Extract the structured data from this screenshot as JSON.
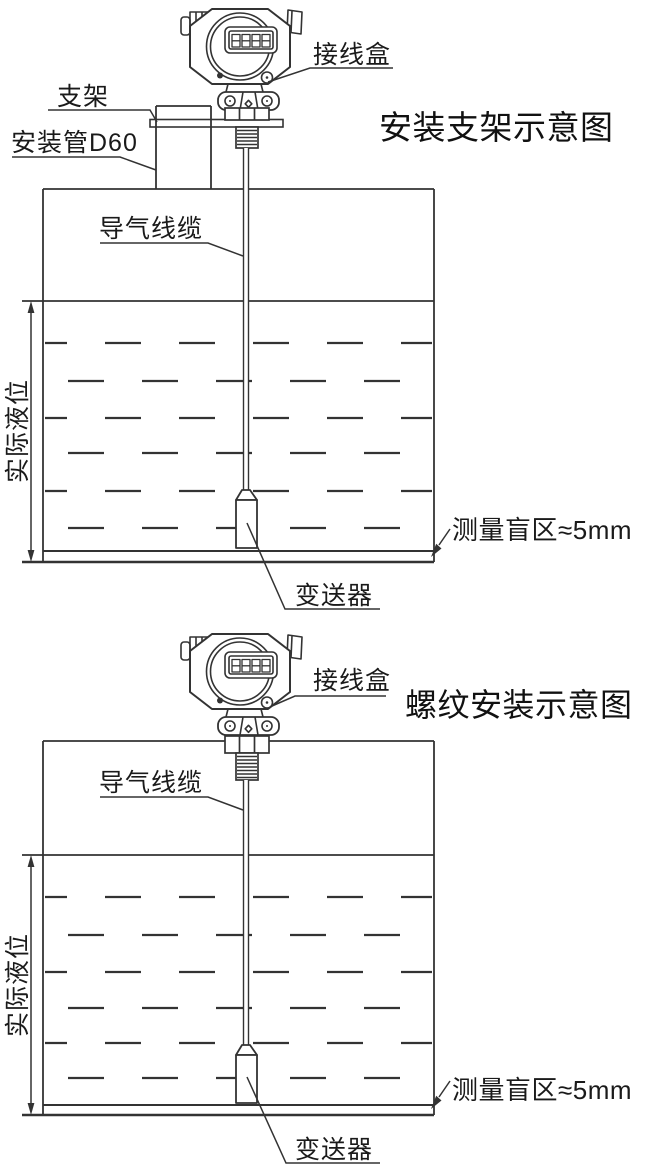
{
  "colors": {
    "background": "#ffffff",
    "line": "#333333",
    "text": "#1a1a1a"
  },
  "diagram_top": {
    "title": "安装支架示意图",
    "labels": {
      "junction_box": "接线盒",
      "bracket": "支架",
      "mounting_pipe": "安装管D60",
      "air_cable": "导气线缆",
      "actual_level": "实际液位",
      "transmitter": "变送器",
      "blind_zone": "测量盲区≈5mm"
    }
  },
  "diagram_bottom": {
    "title": "螺纹安装示意图",
    "labels": {
      "junction_box": "接线盒",
      "air_cable": "导气线缆",
      "actual_level": "实际液位",
      "transmitter": "变送器",
      "blind_zone": "测量盲区≈5mm"
    }
  }
}
